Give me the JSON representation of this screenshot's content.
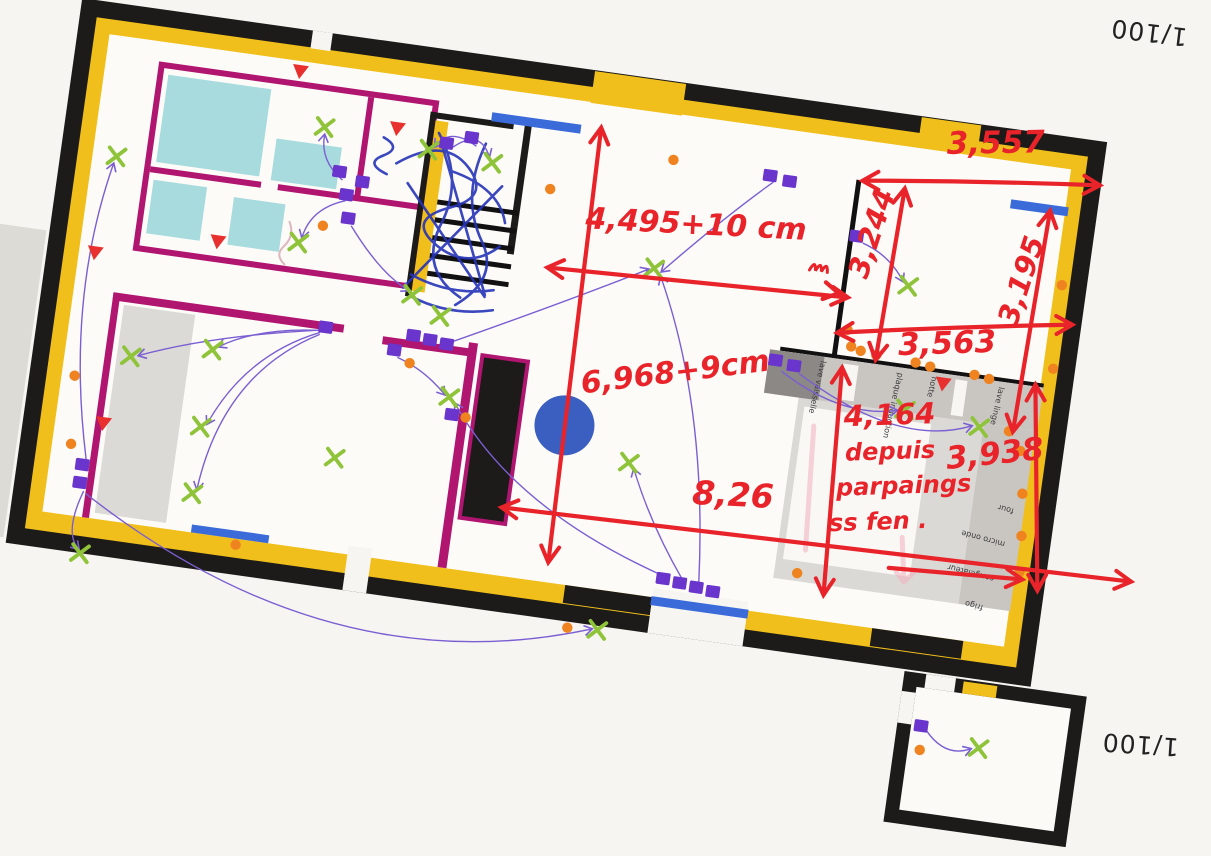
{
  "scale": {
    "top_right": "1/100",
    "bottom_right": "1/100"
  },
  "measurements": {
    "kitchen_top_width": "3,557",
    "kitchen_left_height": "3,244",
    "kitchen_right_height": "3,195",
    "kitchen_bottom_width": "3,563",
    "living_width": "4,495+10 cm",
    "living_height": "6,968+9cm",
    "overall_width": "8,26",
    "kitchen_depth_value": "4,164",
    "kitchen_depth_note1": "depuis",
    "kitchen_depth_note2": "parpaings",
    "kitchen_depth_note3": "ss fen .",
    "kitchen_right_depth": "3,938"
  },
  "appliances": {
    "counter": [
      "lave vaisselle",
      "plaque induction",
      "hotte",
      "lave linge"
    ],
    "right_column": [
      "four",
      "micro onde",
      "congélateur",
      "frigo"
    ]
  },
  "symbols": {
    "socket": "purple-square",
    "light": "green-cross",
    "outlet_point": "orange-dot",
    "detector": "red-triangle",
    "window": "blue-bar",
    "circuit_link": "violet-arc"
  },
  "colors": {
    "outer_wall": "#1c1b19",
    "insulation": "#f1bf1c",
    "partition": "#b0156f",
    "sanitary": "#a7dbde",
    "socket": "#6a35cc",
    "light": "#8fc33a",
    "outlet": "#ef8320",
    "detector": "#e8312e",
    "window": "#3a6bd8",
    "circuit": "#7b5fd2",
    "annotation": "#e8242a",
    "scribble": "#2634b8",
    "table": "#3a5fc0"
  }
}
